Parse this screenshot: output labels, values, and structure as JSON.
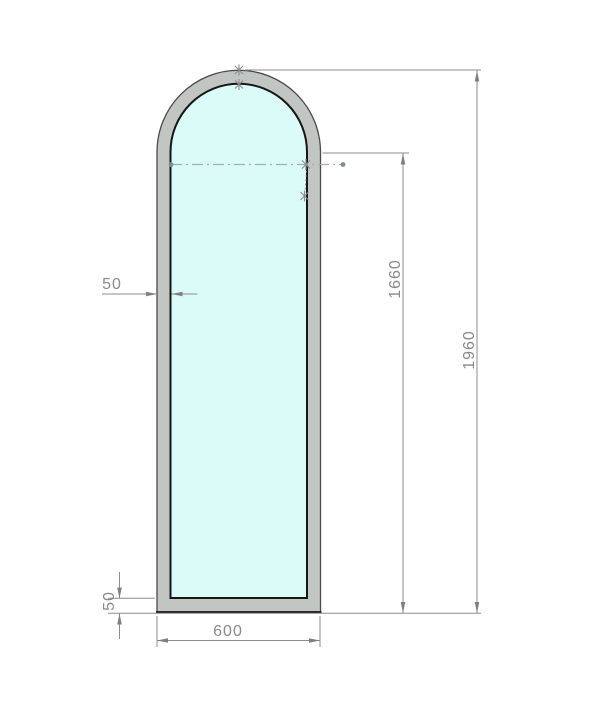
{
  "drawing": {
    "kind": "technical-drawing",
    "subject": "arched-frame-elevation",
    "dimensions": {
      "frame_thickness_mm": "50",
      "bottom_rail_mm": "50",
      "outer_width_mm": "600",
      "spring_height_mm": "1660",
      "overall_height_mm": "1960"
    },
    "colors": {
      "frame_fill": "#c2c6c3",
      "glass_fill": "#dbfbf9",
      "edge_dark": "#1a1a1a",
      "edge_outer": "#4a4a4a",
      "dim_line": "#8c8c8c",
      "dim_text": "#8a8a8a",
      "centerline": "#9fafae",
      "marker": "#8a8a8a"
    }
  }
}
